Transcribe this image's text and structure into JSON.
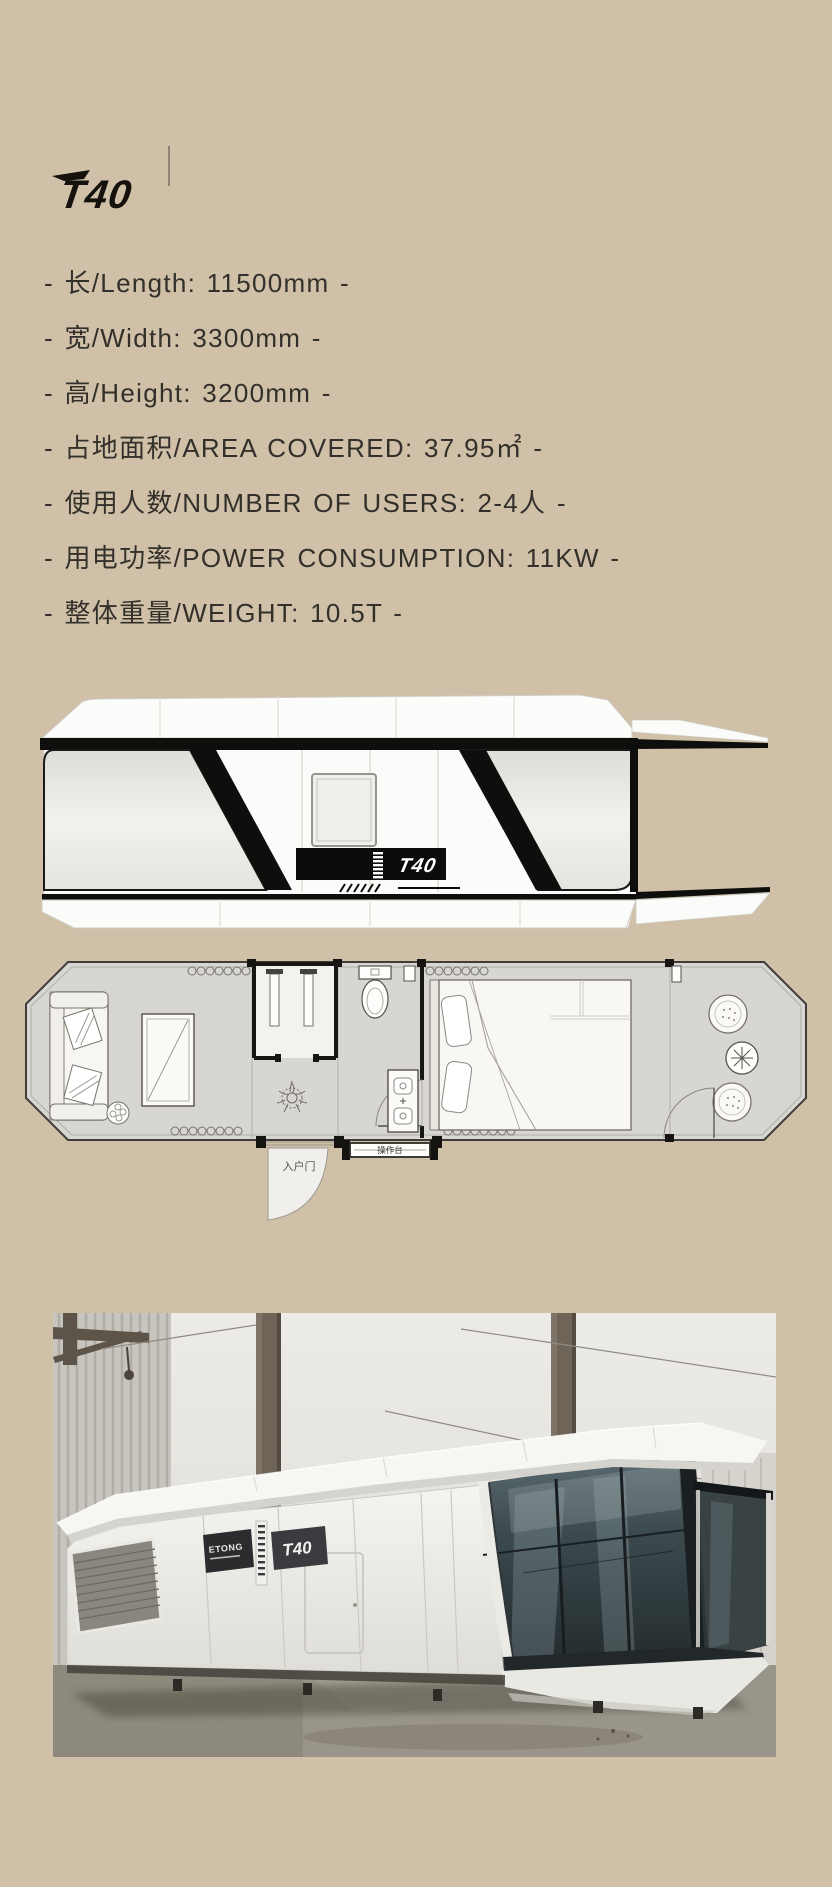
{
  "colors": {
    "background": "#cfc0a7",
    "text": "#33302b",
    "ink": "#0e0e0d",
    "plan_floor": "#d7d6d3",
    "glass": "#3c4a4e"
  },
  "brand": {
    "logo": "T40"
  },
  "specs": {
    "items": [
      {
        "text": "- 长/Length: 11500mm -"
      },
      {
        "text": "- 宽/Width: 3300mm -"
      },
      {
        "text": "- 高/Height: 3200mm -"
      },
      {
        "text": "- 占地面积/AREA COVERED: 37.95㎡ -"
      },
      {
        "text": "- 使用人数/NUMBER OF USERS: 2-4人 -"
      },
      {
        "text": "- 用电功率/POWER CONSUMPTION: 11KW -"
      },
      {
        "text": "- 整体重量/WEIGHT: 10.5T -"
      }
    ]
  },
  "elevation": {
    "badge": "T40"
  },
  "floorplan": {
    "entry_door_label": "入户门",
    "counter_label": "操作台"
  },
  "photo": {
    "brand_label": "ETONG",
    "model_label": "T40"
  }
}
